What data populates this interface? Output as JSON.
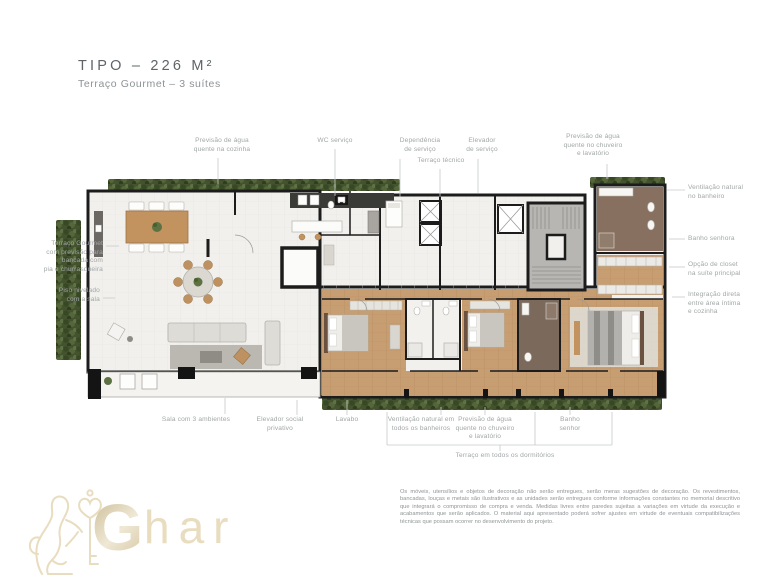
{
  "title": {
    "main": "TIPO – 226 M²",
    "subtitle": "Terraço Gourmet – 3 suítes"
  },
  "callouts": {
    "top": [
      "Previsão de água\nquente na cozinha",
      "WC serviço",
      "Dependência\nde serviço",
      "Terraço técnico",
      "Elevador\nde serviço",
      "Previsão de água\nquente no chuveiro\ne lavatório"
    ],
    "right": [
      "Ventilação natural\nno banheiro",
      "Banho senhora",
      "Opção de closet\nna suíte principal",
      "Integração direta\nentre área íntima\ne cozinha"
    ],
    "left": [
      "Terraço Gourmet\ncom previsão para\nbancada com\npia e churrasqueira",
      "Piso nivelado\ncom a sala"
    ],
    "bottom": [
      "Sala com 3 ambientes",
      "Elevador social\nprivativo",
      "Lavabo",
      "Ventilação natural em\ntodos os banheiros",
      "Previsão de água\nquente no chuveiro\ne lavatório",
      "Banho\nsenhor"
    ],
    "bracket": "Terraço em todos os dormitórios"
  },
  "disclaimer": "Os móveis, utensílios e objetos de decoração não serão entregues, serão meras sugestões de decoração. Os revestimentos, bancadas, louças e metais são ilustrativos e as unidades serão entregues conforme informações constantes no memorial descritivo que integrará o compromisso de compra e venda. Medidas livres entre paredes sujeitas a variações em virtude da execução e acabamentos que serão aplicados. O material aqui apresentado poderá sofrer ajustes em virtude de eventuais compatibilizações técnicas que possam ocorrer no desenvolvimento do projeto.",
  "logo": {
    "initial": "G",
    "rest": "har"
  },
  "colors": {
    "wall": "#1c1c1c",
    "floor": "#f1f0ed",
    "wood": "#c79e71",
    "greenery": "#44522e",
    "stair_core": "#b7b6b3",
    "dark_bath": "#87705f",
    "label_text": "#a2a7a7",
    "title_text": "#5e6467",
    "logo_gold": "#e6dabb"
  }
}
